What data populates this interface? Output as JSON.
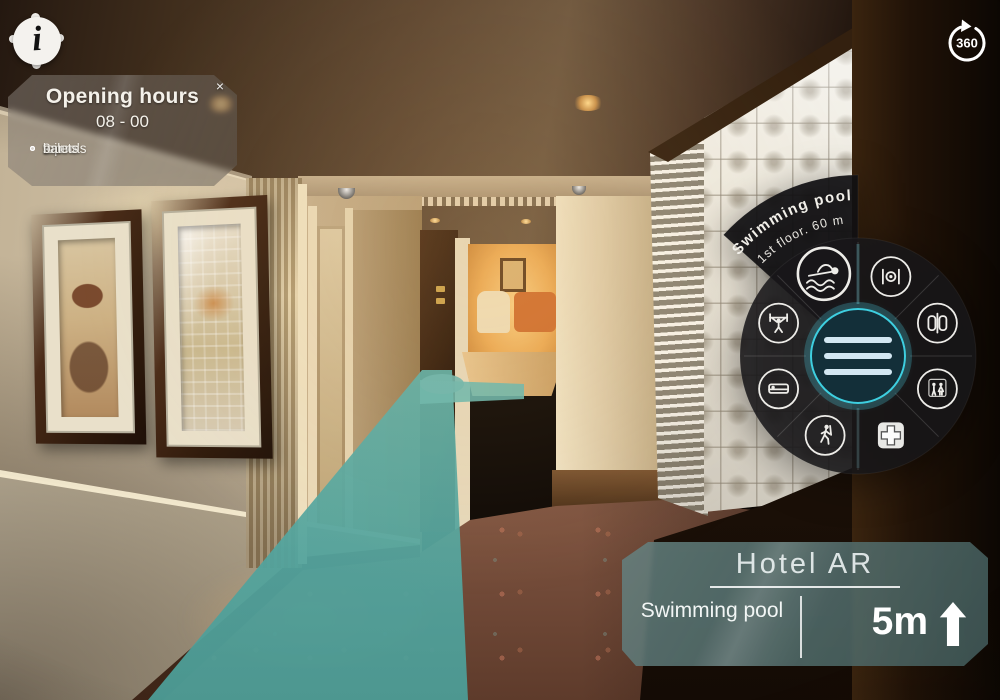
{
  "ui": {
    "info_button": {
      "glyph": "i"
    },
    "rotate_button": {
      "label": "360"
    }
  },
  "opening_hours": {
    "title": "Opening hours",
    "hours": "08 - 00",
    "close": "×",
    "amenities": [
      "2 pools",
      "sauna",
      "toilets",
      "bar"
    ]
  },
  "radial_menu": {
    "selected": {
      "label": "Swimming pool",
      "detail": "1st floor. 60 m"
    },
    "items": [
      "swimming-pool",
      "restaurant",
      "elevator",
      "fitness",
      "room",
      "walking",
      "first-aid",
      "restroom"
    ]
  },
  "destination_panel": {
    "title": "Hotel AR",
    "destination": "Swimming pool",
    "distance": "5m",
    "direction": "up"
  },
  "colors": {
    "path": "#5fb0a9",
    "accent": "#3ecfe0",
    "panel": "#5c7f7e"
  }
}
